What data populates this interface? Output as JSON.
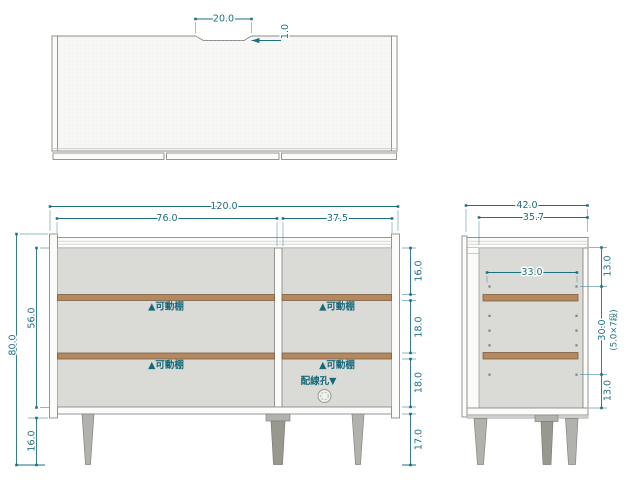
{
  "colors": {
    "accent": "#1e7080",
    "label_text": "#17697a",
    "shelf_wood": "#b5895f",
    "panel": "#fbfbfa",
    "interior": "#dadad7"
  },
  "top_view": {
    "notch_width": "20.0",
    "notch_depth": "1.0"
  },
  "front_view": {
    "total_width": "120.0",
    "left_section_width": "76.0",
    "right_section_width": "37.5",
    "total_height": "80.0",
    "interior_height": "56.0",
    "leg_height": "16.0",
    "top_space": "16.0",
    "middle_space": "18.0",
    "lower_space": "18.0",
    "floor_clearance": "17.0",
    "shelf_label": "▲可動棚",
    "cable_hole_label": "配線孔▼"
  },
  "side_view": {
    "total_depth": "42.0",
    "inner_depth": "35.7",
    "shelf_depth": "33.0",
    "top_offset": "13.0",
    "hole_span": "30.0",
    "hole_pitch_note": "(5.0×7段)",
    "bottom_offset": "13.0"
  }
}
